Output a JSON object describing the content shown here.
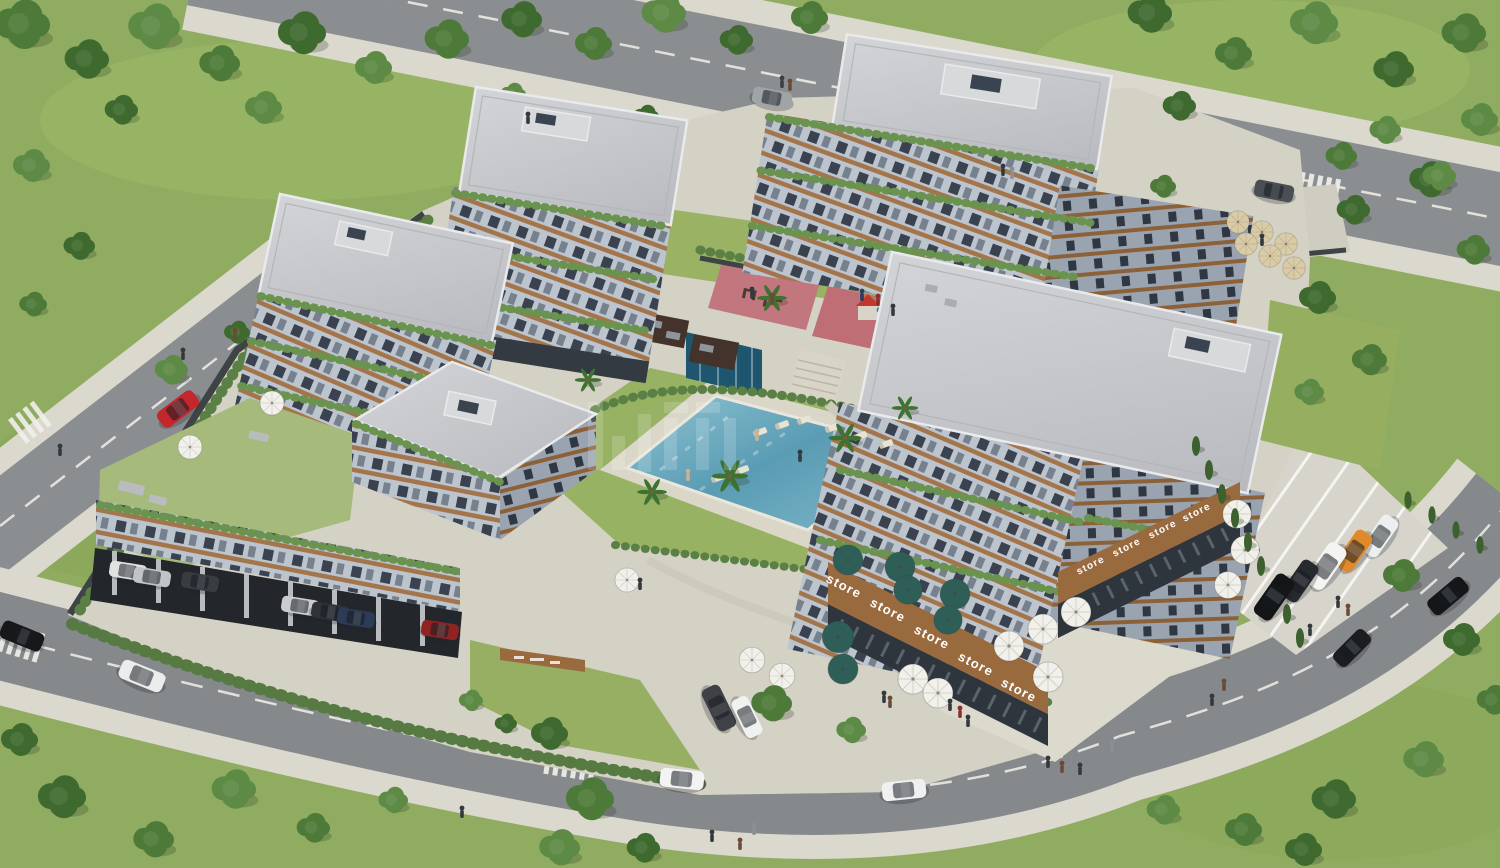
{
  "meta": {
    "description": "Aerial 3D architectural rendering of a modern residential complex: five terraced apartment buildings with wood-trim balconies and planted terraces, central swimming pool with sun loungers and palm trees, playground and fitness area, ground-floor shops labelled 'store' with cafe umbrellas, landscaped gardens, perimeter roads with cars and pedestrians, and parking areas."
  },
  "palette": {
    "grass": "#90ac61",
    "lawn": "#98b264",
    "tree_greens": [
      "#4e7a39",
      "#3f6a2f",
      "#5d8a45",
      "#6f9a50"
    ],
    "road": "#8a8e90",
    "sidewalk": "#dbd8cd",
    "platform_paving": "#d4d1c5",
    "facade_light": "#bcc4ce",
    "facade_shade": "#9aa4b1",
    "wood_trim": "#a4754a",
    "window": "#39424e",
    "roof": "#c6c8cc",
    "pool_water": "#5a9cb4",
    "water_feature": "#1d566e",
    "playground_rubber": "#c2777e",
    "store_band": "#9a6a3f",
    "umbrella_teal": "#2d5f58",
    "umbrella_white": "#f1f0ea",
    "umbrella_tan": "#d9cba6"
  },
  "signs": {
    "label": "store",
    "items": [
      [
        842,
        590,
        27,
        13
      ],
      [
        886,
        614,
        27,
        13
      ],
      [
        930,
        641,
        27,
        13
      ],
      [
        974,
        668,
        27,
        13
      ],
      [
        1017,
        694,
        27,
        13
      ],
      [
        1092,
        568,
        -27,
        10
      ],
      [
        1128,
        550,
        -27,
        10
      ],
      [
        1164,
        532,
        -27,
        10
      ],
      [
        1198,
        515,
        -27,
        10
      ]
    ]
  },
  "watermark": {
    "present": true,
    "legible": false,
    "opacity": 0.16,
    "bars": [
      [
        588,
        402,
        15,
        68
      ],
      [
        612,
        436,
        13,
        34
      ],
      [
        638,
        414,
        13,
        58
      ],
      [
        664,
        402,
        24,
        11
      ],
      [
        664,
        418,
        13,
        52
      ],
      [
        696,
        402,
        24,
        11
      ],
      [
        696,
        418,
        13,
        52
      ],
      [
        724,
        418,
        12,
        52
      ]
    ]
  },
  "instances": {
    "trees_back": {
      "symbol": "#sym-tree",
      "name": "tree",
      "fields": [
        "x",
        "y",
        "s",
        "ci"
      ],
      "colors": [
        "#4e7a39",
        "#3f6a2f",
        "#5d8a45",
        "#6f9a50"
      ],
      "items": [
        [
          20,
          28,
          1.5,
          0
        ],
        [
          85,
          62,
          1.2,
          1
        ],
        [
          152,
          30,
          1.4,
          2
        ],
        [
          218,
          66,
          1.1,
          0
        ],
        [
          300,
          36,
          1.3,
          1
        ],
        [
          372,
          70,
          1.0,
          2
        ],
        [
          445,
          42,
          1.2,
          0
        ],
        [
          120,
          112,
          0.9,
          1
        ],
        [
          262,
          110,
          1.0,
          2
        ],
        [
          520,
          22,
          1.1,
          1
        ],
        [
          592,
          46,
          1.0,
          0
        ],
        [
          662,
          16,
          1.2,
          2
        ],
        [
          735,
          42,
          0.9,
          1
        ],
        [
          808,
          20,
          1.0,
          0
        ],
        [
          30,
          168,
          1.0,
          2
        ],
        [
          78,
          248,
          0.85,
          1
        ],
        [
          32,
          306,
          0.75,
          0
        ],
        [
          1148,
          16,
          1.2,
          1
        ],
        [
          1232,
          56,
          1.0,
          0
        ],
        [
          1312,
          26,
          1.3,
          2
        ],
        [
          1392,
          72,
          1.1,
          1
        ],
        [
          1462,
          36,
          1.2,
          0
        ],
        [
          1478,
          122,
          1.0,
          2
        ],
        [
          1428,
          182,
          1.1,
          1
        ],
        [
          1472,
          252,
          0.9,
          0
        ],
        [
          1384,
          132,
          0.85,
          2
        ],
        [
          1178,
          108,
          0.9,
          1
        ],
        [
          1340,
          158,
          0.85,
          0
        ],
        [
          1438,
          178,
          0.9,
          2
        ],
        [
          1316,
          300,
          1.0,
          1
        ],
        [
          1368,
          362,
          0.95,
          0
        ],
        [
          1308,
          394,
          0.8,
          2
        ],
        [
          1352,
          212,
          0.9,
          1
        ],
        [
          512,
          96,
          0.7,
          2
        ],
        [
          645,
          118,
          0.7,
          1
        ],
        [
          1162,
          188,
          0.7,
          0
        ],
        [
          170,
          372,
          0.9,
          2
        ],
        [
          236,
          334,
          0.7,
          1
        ]
      ]
    },
    "trees_front": {
      "symbol": "#sym-tree",
      "name": "tree",
      "fields": [
        "x",
        "y",
        "s",
        "ci"
      ],
      "colors": [
        "#4e7a39",
        "#3f6a2f",
        "#5d8a45",
        "#6f9a50"
      ],
      "items": [
        [
          60,
          800,
          1.3,
          1
        ],
        [
          152,
          842,
          1.1,
          0
        ],
        [
          232,
          792,
          1.2,
          2
        ],
        [
          18,
          742,
          1.0,
          1
        ],
        [
          312,
          830,
          0.9,
          0
        ],
        [
          392,
          802,
          0.8,
          2
        ],
        [
          548,
          736,
          1.0,
          1
        ],
        [
          588,
          802,
          1.3,
          0
        ],
        [
          558,
          850,
          1.1,
          2
        ],
        [
          642,
          850,
          0.9,
          1
        ],
        [
          770,
          706,
          1.1,
          0
        ],
        [
          850,
          732,
          0.8,
          2
        ],
        [
          1460,
          642,
          1.0,
          1
        ],
        [
          1492,
          702,
          0.9,
          0
        ],
        [
          1422,
          762,
          1.1,
          2
        ],
        [
          1332,
          802,
          1.2,
          1
        ],
        [
          1242,
          832,
          1.0,
          0
        ],
        [
          1162,
          812,
          0.9,
          2
        ],
        [
          1302,
          852,
          1.0,
          1
        ],
        [
          1400,
          578,
          1.0,
          0
        ],
        [
          470,
          702,
          0.65,
          2
        ],
        [
          505,
          725,
          0.6,
          1
        ]
      ]
    },
    "cypresses": {
      "symbol": "#sym-cypress",
      "name": "cypress-tree",
      "fields": [
        "x",
        "y",
        "s"
      ],
      "colors": [
        "#3c602e"
      ],
      "items": [
        [
          1196,
          446,
          0.9
        ],
        [
          1209,
          470,
          0.9
        ],
        [
          1222,
          494,
          0.9
        ],
        [
          1235,
          518,
          0.9
        ],
        [
          1248,
          542,
          0.9
        ],
        [
          1261,
          566,
          0.9
        ],
        [
          1274,
          590,
          0.9
        ],
        [
          1287,
          614,
          0.9
        ],
        [
          1300,
          638,
          0.9
        ],
        [
          1408,
          500,
          0.8
        ],
        [
          1432,
          515,
          0.8
        ],
        [
          1456,
          530,
          0.8
        ],
        [
          1480,
          545,
          0.8
        ]
      ]
    },
    "palms": {
      "symbol": "#sym-palm",
      "name": "palm-tree",
      "fields": [
        "x",
        "y",
        "s"
      ],
      "colors": [
        "#3e7231"
      ],
      "items": [
        [
          730,
          476,
          1.1
        ],
        [
          845,
          438,
          1.0
        ],
        [
          652,
          492,
          0.9
        ],
        [
          772,
          298,
          0.9
        ],
        [
          588,
          380,
          0.8
        ],
        [
          905,
          408,
          0.8
        ]
      ]
    },
    "loungers": {
      "symbol": "#sym-lounger",
      "name": "sun-lounger",
      "fields": [
        "x",
        "y",
        "r"
      ],
      "colors": [
        "#e8e3d2"
      ],
      "items": [
        [
          760,
          432,
          -20
        ],
        [
          782,
          425,
          -20
        ],
        [
          804,
          420,
          -20
        ],
        [
          832,
          428,
          -20
        ],
        [
          860,
          436,
          -20
        ],
        [
          886,
          444,
          -20
        ],
        [
          742,
          470,
          -20
        ],
        [
          718,
          478,
          -20
        ]
      ]
    },
    "umbrellas": {
      "symbol": "#sym-umbrella",
      "name": "patio-umbrella",
      "fields": [
        "x",
        "y",
        "s",
        "c"
      ],
      "items": [
        [
          848,
          560,
          1,
          "#2d5f58"
        ],
        [
          900,
          567,
          1,
          "#2d5f58"
        ],
        [
          908,
          590,
          0.95,
          "#2d5f58"
        ],
        [
          955,
          594,
          1,
          "#2d5f58"
        ],
        [
          948,
          620,
          0.95,
          "#2d5f58"
        ],
        [
          838,
          637,
          1.05,
          "#2d5f58"
        ],
        [
          843,
          669,
          1,
          "#2d5f58"
        ],
        [
          913,
          679,
          1,
          "#f1f0ea"
        ],
        [
          938,
          693,
          1,
          "#f1f0ea"
        ],
        [
          1009,
          646,
          1,
          "#f1f0ea"
        ],
        [
          1043,
          629,
          1,
          "#f1f0ea"
        ],
        [
          1048,
          677,
          1,
          "#f1f0ea"
        ],
        [
          1076,
          612,
          1,
          "#f1f0ea"
        ],
        [
          1237,
          514,
          0.95,
          "#f1f0ea"
        ],
        [
          1245,
          550,
          0.95,
          "#f1f0ea"
        ],
        [
          1228,
          585,
          0.9,
          "#f1f0ea"
        ],
        [
          752,
          660,
          0.85,
          "#f1f0ea"
        ],
        [
          782,
          676,
          0.85,
          "#f1f0ea"
        ],
        [
          272,
          403,
          0.8,
          "#f1f0ea"
        ],
        [
          190,
          447,
          0.8,
          "#f1f0ea"
        ],
        [
          627,
          580,
          0.8,
          "#f1f0ea"
        ],
        [
          1238,
          222,
          0.75,
          "#d9cba6"
        ],
        [
          1262,
          232,
          0.75,
          "#d9cba6"
        ],
        [
          1286,
          244,
          0.75,
          "#d9cba6"
        ],
        [
          1246,
          244,
          0.75,
          "#d9cba6"
        ],
        [
          1270,
          256,
          0.75,
          "#d9cba6"
        ],
        [
          1294,
          268,
          0.75,
          "#d9cba6"
        ]
      ]
    },
    "cars": {
      "symbol": "#sym-car",
      "name": "car",
      "fields": [
        "x",
        "y",
        "r",
        "c",
        "s"
      ],
      "items": [
        [
          178,
          409,
          -37,
          "#c3272b",
          1
        ],
        [
          772,
          98,
          11,
          "#9fa4a7",
          0.9
        ],
        [
          1274,
          191,
          11,
          "#4a4f54",
          0.9
        ],
        [
          1380,
          536,
          -55,
          "#eceff0",
          1
        ],
        [
          1354,
          551,
          -55,
          "#e0892a",
          1
        ],
        [
          1326,
          566,
          -55,
          "#f4f4f2",
          1.12
        ],
        [
          1300,
          581,
          -55,
          "#26292d",
          1
        ],
        [
          1274,
          597,
          -55,
          "#131517",
          1.1
        ],
        [
          1448,
          596,
          -40,
          "#141618",
          1
        ],
        [
          1352,
          648,
          -45,
          "#1b1d20",
          0.95
        ],
        [
          719,
          708,
          64,
          "#3e4145",
          1.05
        ],
        [
          747,
          717,
          64,
          "#f0f1f1",
          0.95
        ],
        [
          682,
          779,
          6,
          "#f2f3f2",
          1
        ],
        [
          904,
          790,
          -6,
          "#eff0ef",
          1
        ],
        [
          142,
          676,
          22,
          "#ebedec",
          1.05
        ],
        [
          22,
          636,
          22,
          "#17181a",
          1
        ],
        [
          128,
          571,
          9,
          "#e0e2e2",
          0.85
        ],
        [
          152,
          577,
          9,
          "#c0c4c6",
          0.85
        ],
        [
          200,
          582,
          9,
          "#3a3d40",
          0.85
        ],
        [
          300,
          606,
          9,
          "#caccce",
          0.85
        ],
        [
          330,
          612,
          9,
          "#2f3236",
          0.85
        ],
        [
          356,
          618,
          9,
          "#2c3b56",
          0.85
        ],
        [
          440,
          630,
          9,
          "#8e2422",
          0.85
        ]
      ]
    },
    "people": {
      "symbol": "#sym-person",
      "name": "pedestrian",
      "fields": [
        "x",
        "y",
        "c"
      ],
      "items": [
        [
          782,
          84,
          "#3a3f45"
        ],
        [
          790,
          87,
          "#6b4a38"
        ],
        [
          1003,
          172,
          "#33383d"
        ],
        [
          1012,
          175,
          "#8a8f94"
        ],
        [
          183,
          356,
          "#33383d"
        ],
        [
          235,
          336,
          "#6b4a38"
        ],
        [
          60,
          452,
          "#33383d"
        ],
        [
          688,
          477,
          "#c9b194"
        ],
        [
          757,
          437,
          "#c9b194"
        ],
        [
          800,
          458,
          "#33383d"
        ],
        [
          884,
          699,
          "#33383d"
        ],
        [
          890,
          704,
          "#6b4a38"
        ],
        [
          950,
          707,
          "#33383d"
        ],
        [
          960,
          714,
          "#8a2f2c"
        ],
        [
          968,
          723,
          "#33383d"
        ],
        [
          1048,
          764,
          "#33383d"
        ],
        [
          1062,
          769,
          "#6b4a38"
        ],
        [
          1080,
          771,
          "#33383d"
        ],
        [
          1112,
          748,
          "#8a8f94"
        ],
        [
          1212,
          702,
          "#33383d"
        ],
        [
          1224,
          687,
          "#6b4a38"
        ],
        [
          1338,
          604,
          "#33383d"
        ],
        [
          1348,
          612,
          "#6b4a38"
        ],
        [
          1310,
          632,
          "#33383d"
        ],
        [
          712,
          838,
          "#33383d"
        ],
        [
          740,
          846,
          "#6b4a38"
        ],
        [
          754,
          831,
          "#8a8f94"
        ],
        [
          462,
          814,
          "#33383d"
        ],
        [
          878,
          302,
          "#8a2f2c"
        ],
        [
          893,
          312,
          "#33383d"
        ],
        [
          862,
          297,
          "#2c3b56"
        ],
        [
          752,
          295,
          "#33383d"
        ],
        [
          772,
          301,
          "#6b4a38"
        ],
        [
          640,
          586,
          "#33383d"
        ],
        [
          1262,
          242,
          "#33383d"
        ],
        [
          528,
          120,
          "#33383d"
        ]
      ]
    }
  }
}
